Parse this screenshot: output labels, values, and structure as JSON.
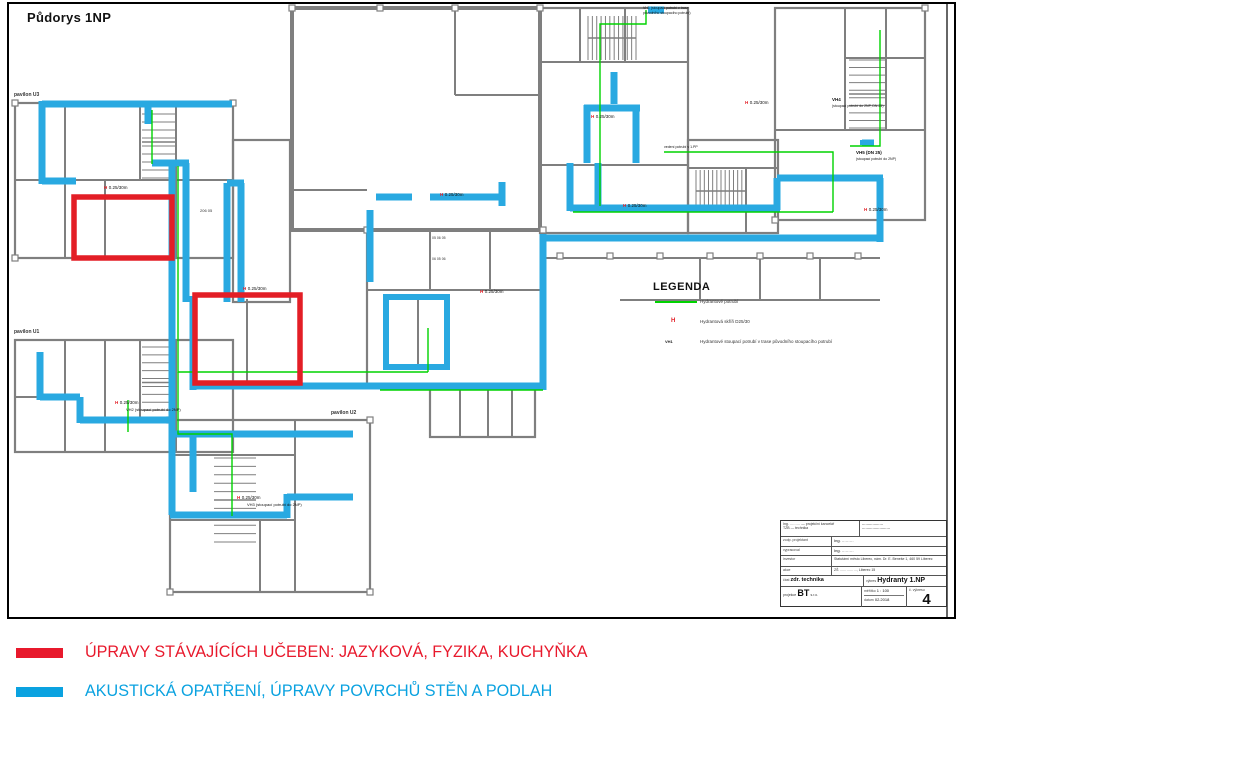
{
  "colors": {
    "highlight_blue": "#29A9E1",
    "highlight_red": "#E31E26",
    "pipe_green": "#00D300",
    "wall_gray": "#7F7F7F",
    "footer_red": "#E8192C",
    "footer_blue": "#0AA2E0"
  },
  "sheet": {
    "title": "Půdorys 1NP",
    "pavilion_u3": "pavilon U3",
    "pavilion_u1": "pavilon U1",
    "pavilion_u2": "pavilon U2"
  },
  "legend": {
    "title": "LEGENDA",
    "items": [
      {
        "symbol": "line",
        "label": "Hydrantové potrubí"
      },
      {
        "symbol": "H",
        "label": "Hydrantová skříň D25/30"
      },
      {
        "symbol": "VH1",
        "label": "Hydrantové stoupací potrubí v trase původního stoupacího potrubí"
      }
    ]
  },
  "annotations": {
    "hydrant_h": "H",
    "hydrant_spec": "0.25/30m",
    "vh1_line1": "VH1 (stoupací potrubí v trase",
    "vh1_line2": "původního stoupacího potrubí)",
    "vh2": "VH2  (stoupací potrubí do 2NP)",
    "vh3": "VH3  (stoupací potrubí do 2NP)",
    "vh4": "VH4",
    "vh4_note": "(stoupací potrubí do 2NP, DN 25)",
    "vh5": "VH5 (DN 25)",
    "vh5_note": "(stoupací potrubí do 2NP)",
    "pipe_note": "vedení potrubí v 1.PP",
    "room_a": "206 05",
    "room_b": "05  06  05",
    "room_c": "06  05  06"
  },
  "titleblock": {
    "header_left_1": "Ing. ……… — projekční kancelář",
    "header_left_2": "TZB — technika",
    "header_right_1": "………………",
    "header_right_2": "……………………",
    "rows": [
      {
        "label": "zodp. projektant",
        "value": "Ing. ………"
      },
      {
        "label": "vypracoval",
        "value": "Ing. ………"
      },
      {
        "label": "investor",
        "value": "Statutární město Liberec, nám. Dr. E. Beneše 1, 460 59 Liberec"
      },
      {
        "label": "akce",
        "value": "ZŠ ……………, Liberec 15"
      }
    ],
    "part_label": "část",
    "part": "zdr. technika",
    "drawing_label": "výkres",
    "drawing": "Hydranty 1.NP",
    "stamp": "BT",
    "stamp_note_1": "projekce",
    "stamp_note_2": "s.r.o.",
    "scale_label": "měřítko",
    "scale": "1 : 100",
    "date_label": "datum",
    "date": "02.2018",
    "number_label": "č. výkresu",
    "number": "4"
  },
  "footer": {
    "items": [
      {
        "label": "ÚPRAVY STÁVAJÍCÍCH UČEBEN: JAZYKOVÁ, FYZIKA, KUCHYŇKA",
        "color": "#E8192C"
      },
      {
        "label": "AKUSTICKÁ OPATŘENÍ, ÚPRAVY POVRCHŮ STĚN A PODLAH",
        "color": "#0AA2E0"
      }
    ]
  }
}
